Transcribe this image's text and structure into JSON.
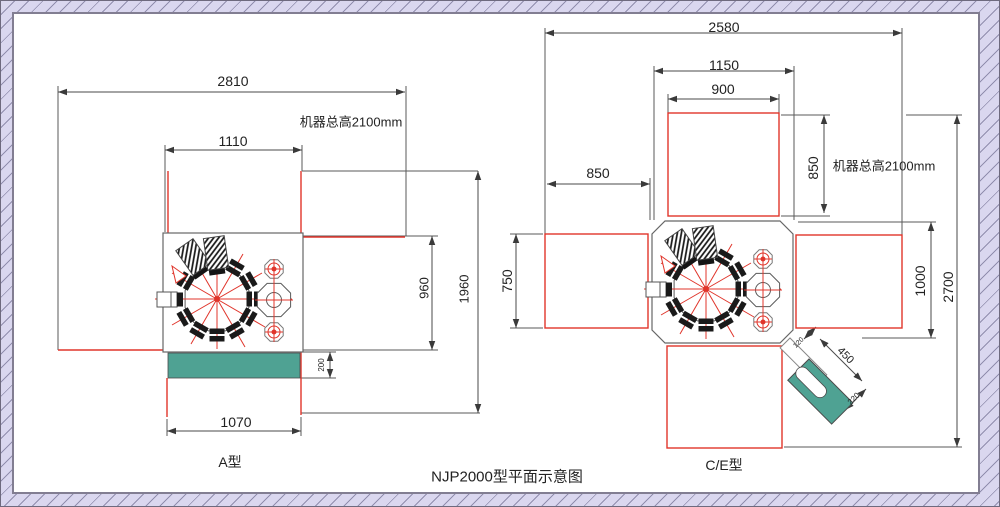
{
  "title": "NJP2000型平面示意图",
  "colors": {
    "dimension_red": "#e0352b",
    "machine_teal": "#4fa293",
    "frame_lavender": "#dad7ef",
    "line_gray": "#4a4a4a"
  },
  "type_a": {
    "label": "A型",
    "height_note": "机器总高2100mm",
    "dims": {
      "total_width": "2810",
      "body_width": "1110",
      "right_depth": "960",
      "total_depth": "1960",
      "outfeed_width": "1070",
      "belt_depth": "200"
    }
  },
  "type_ce": {
    "label": "C/E型",
    "height_note": "机器总高2100mm",
    "dims": {
      "total_width": "2580",
      "body_width": "1150",
      "hopper_width": "900",
      "left_clearance": "850",
      "top_depth": "850",
      "left_depth": "750",
      "right_depth": "1000",
      "total_depth": "2700",
      "chute_length": "450",
      "chute_width": "220",
      "chute_neck": "120"
    }
  }
}
